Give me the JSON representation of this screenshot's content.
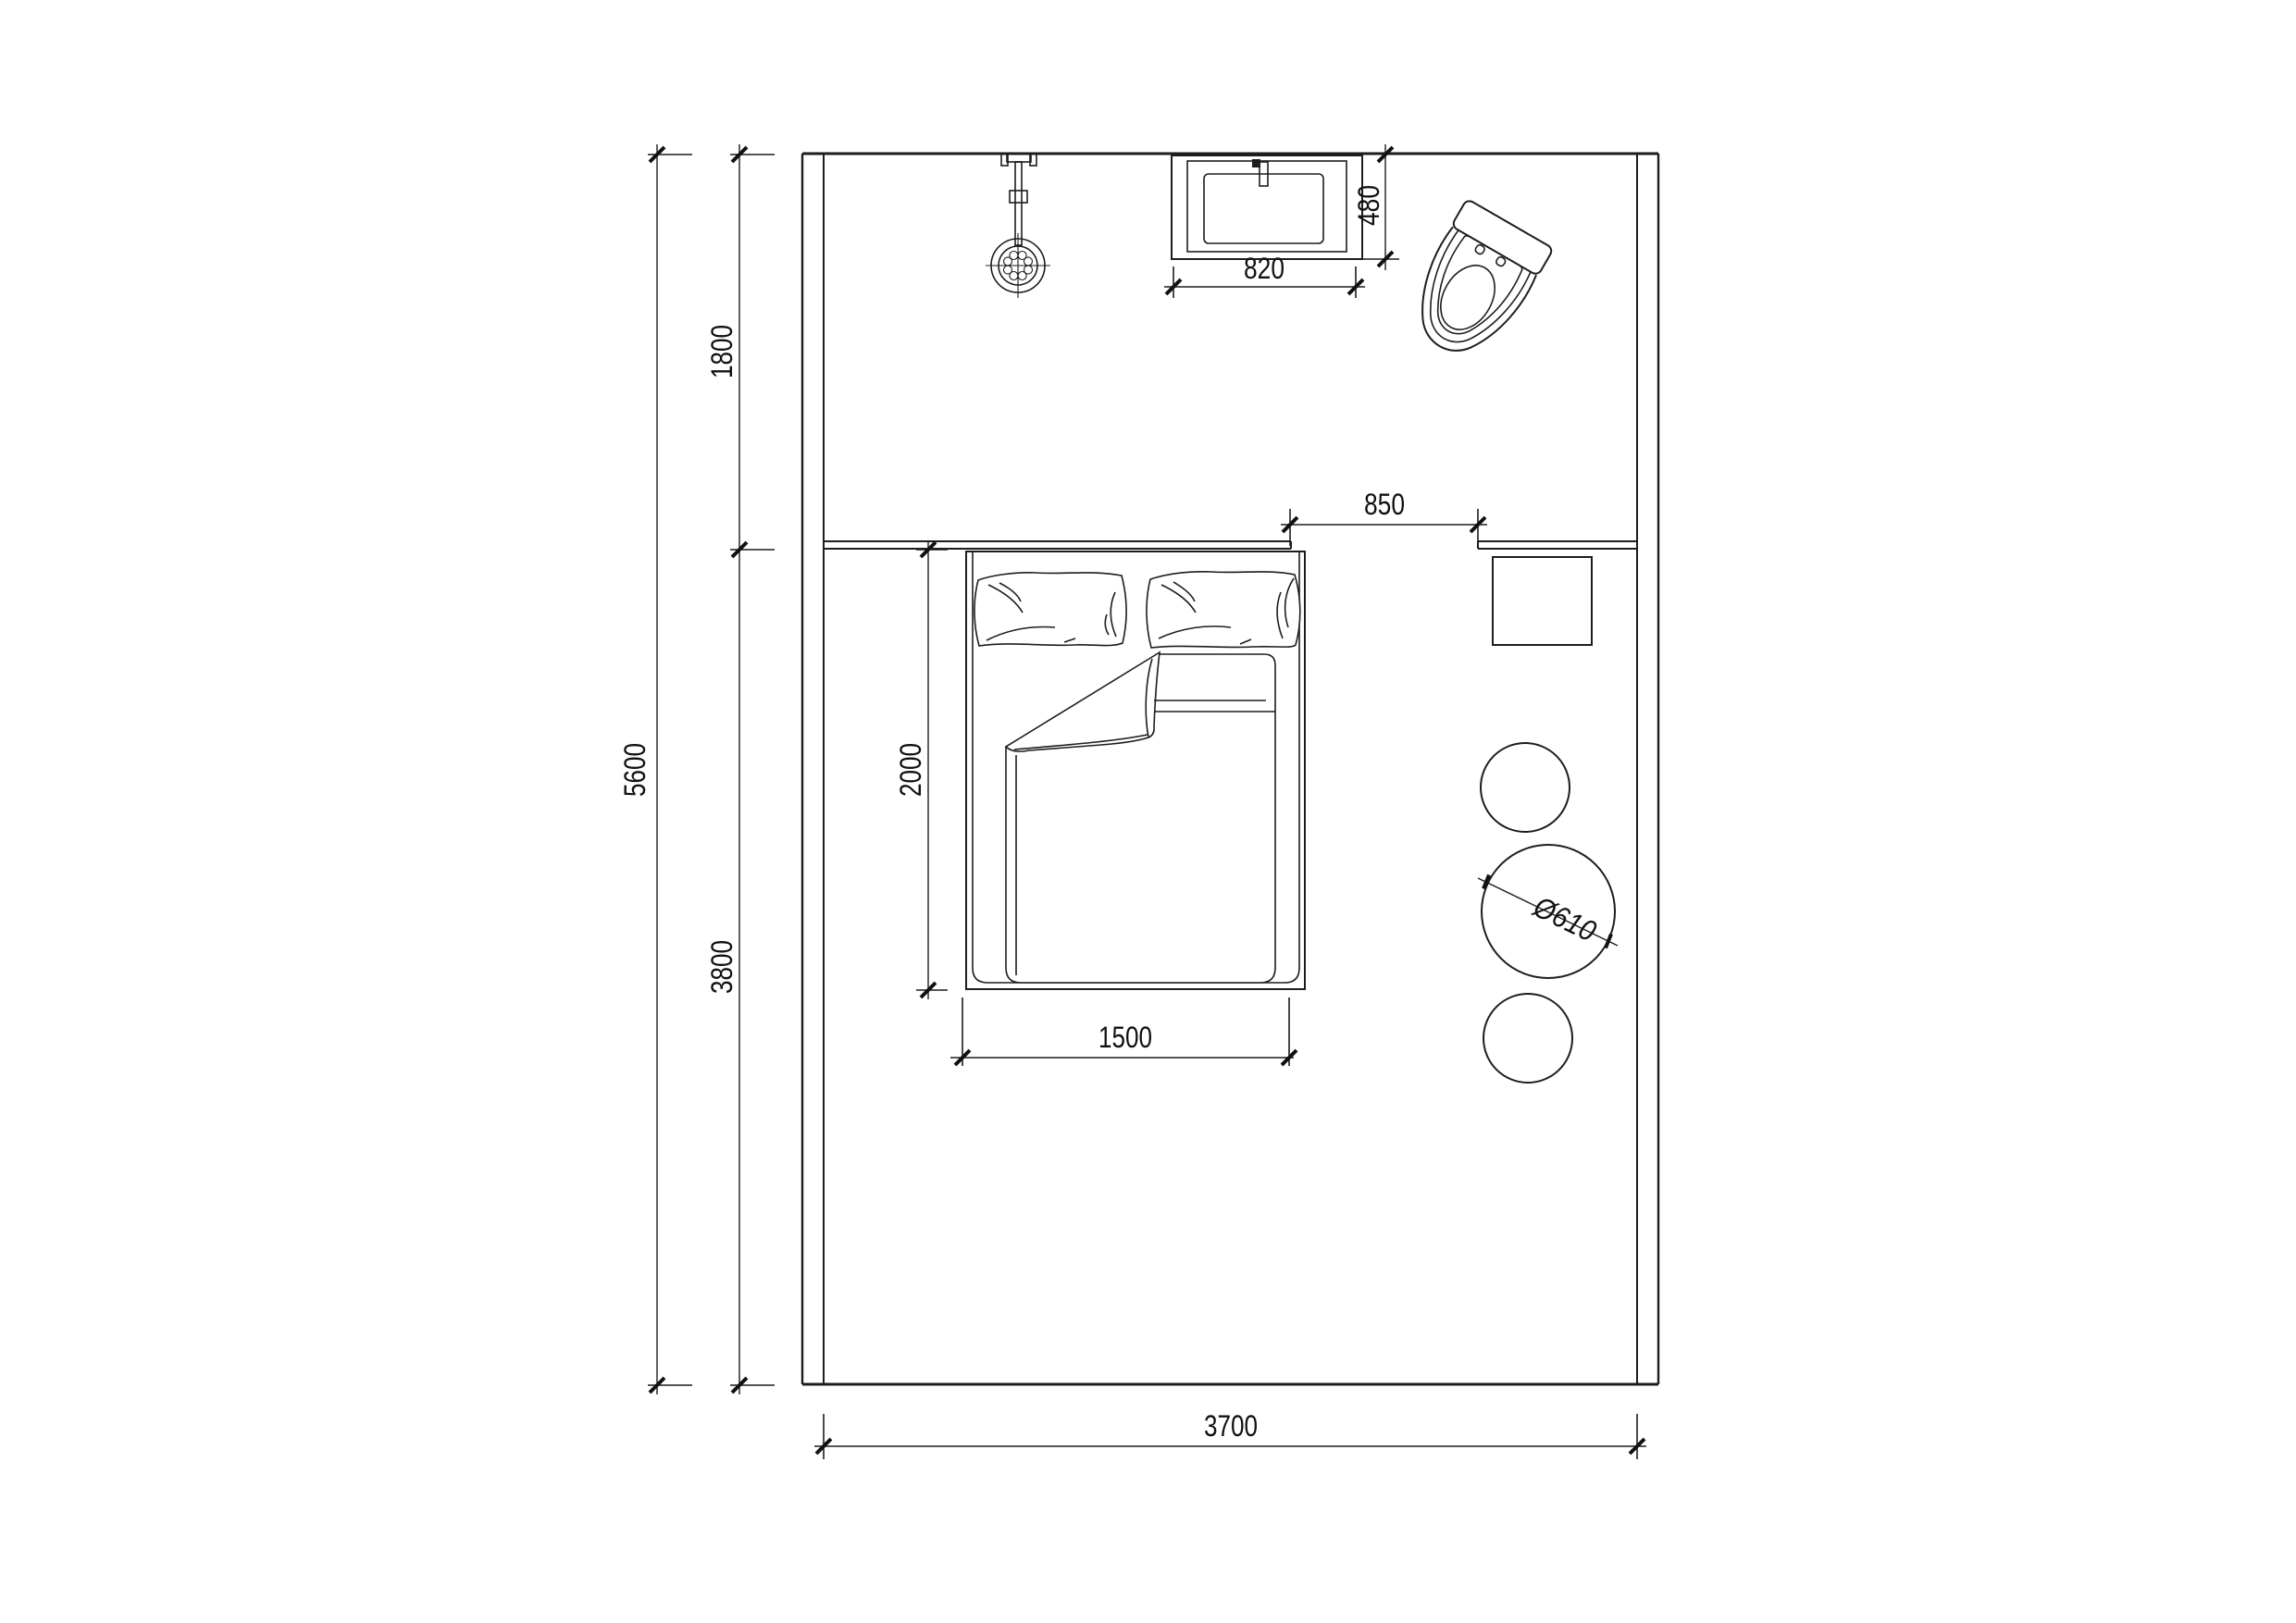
{
  "colors": {
    "line": "#1d1d1d",
    "text": "#111111",
    "background": "#ffffff"
  },
  "dimensions": {
    "overall_depth": "5600",
    "bath_zone_depth": "1800",
    "bedroom_zone_depth": "3800",
    "overall_width": "3700",
    "bed_length": "2000",
    "bed_width": "1500",
    "passage_width": "850",
    "basin_width": "820",
    "basin_depth": "480",
    "round_table_diameter": "Ø610"
  }
}
